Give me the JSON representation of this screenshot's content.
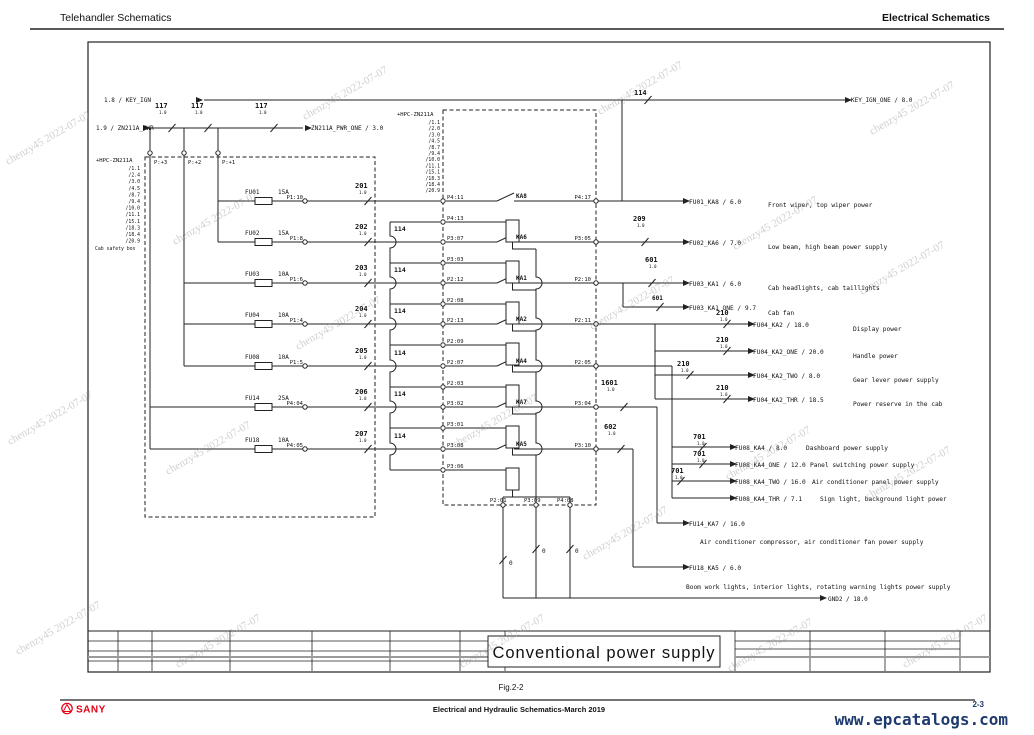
{
  "header": {
    "left": "Telehandler Schematics",
    "right": "Electrical Schematics"
  },
  "watermark": {
    "text": "chenzy45 2022-07-07"
  },
  "title_block": {
    "title": "Conventional  power  supply"
  },
  "footer": {
    "figure": "Fig.2-2",
    "doc": "Electrical and Hydraulic Schematics-March 2019",
    "page": "2-3",
    "site": "www.epcatalogs.com",
    "brand": "SANY"
  },
  "colors": {
    "brand_red": "#e60012",
    "link_navy": "#1e3a6e",
    "line": "#222222"
  },
  "schematic": {
    "spec": "1.0",
    "bus114": "114",
    "top": {
      "key_ign": "1.8 / KEY_IGN",
      "key_ign_one": "KEY_IGN_ONE / 8.0",
      "wire_114": "114",
      "zn_pwr": "1.9 / ZN211A_PWR",
      "zn_pwr_one": "ZN211A_PWR_ONE / 3.0",
      "wire_117": "117"
    },
    "hpc_left": {
      "name": "+HPC-ZN211A",
      "refs": [
        "/1.1",
        "/2.4",
        "/3.0",
        "/4.5",
        "/8.7",
        "/9.4",
        "/10.0",
        "/11.1",
        "/15.1",
        "/18.3",
        "/18.4",
        "/20.9"
      ],
      "caption": "Cab safety box"
    },
    "hpc_mid": {
      "name": "+HPC-ZN211A",
      "refs": [
        "/1.1",
        "/2.0",
        "/3.0",
        "/4.5",
        "/8.7",
        "/9.4",
        "/10.0",
        "/11.1",
        "/15.1",
        "/18.3",
        "/18.4",
        "/20.9"
      ]
    },
    "plus_pins": [
      "P:+3",
      "P:+2",
      "P:+1"
    ],
    "fuses": [
      {
        "name": "FU01",
        "rating": "15A",
        "pin": "P1:10",
        "wire": "201"
      },
      {
        "name": "FU02",
        "rating": "15A",
        "pin": "P1:8",
        "wire": "202"
      },
      {
        "name": "FU03",
        "rating": "10A",
        "pin": "P1:6",
        "wire": "203"
      },
      {
        "name": "FU04",
        "rating": "10A",
        "pin": "P1:4",
        "wire": "204"
      },
      {
        "name": "FU08",
        "rating": "10A",
        "pin": "P1:5",
        "wire": "205"
      },
      {
        "name": "FU14",
        "rating": "25A",
        "pin": "P4:04",
        "wire": "206"
      },
      {
        "name": "FU18",
        "rating": "10A",
        "pin": "P4:05",
        "wire": "207"
      }
    ],
    "relays": [
      {
        "name": "KA8",
        "in": "P4:11",
        "coil": "P4:13",
        "out": "P4:17"
      },
      {
        "name": "KA6",
        "in": "P3:07",
        "coil": "P3:03",
        "out": "P3:05"
      },
      {
        "name": "KA1",
        "in": "P2:12",
        "coil": "P2:08",
        "out": "P2:10"
      },
      {
        "name": "KA2",
        "in": "P2:13",
        "coil": "P2:09",
        "out": "P2:11"
      },
      {
        "name": "KA4",
        "in": "P2:07",
        "coil": "P2:03",
        "out": "P2:05"
      },
      {
        "name": "KA7",
        "in": "P3:02",
        "coil": "P3:01",
        "out": "P3:04"
      },
      {
        "name": "KA5",
        "in": "P3:08",
        "coil": "P3:06",
        "out": "P3:10"
      }
    ],
    "ground_pins": [
      "P2:01",
      "P3:09",
      "P4:08"
    ],
    "ground_wire": "0",
    "gnd": "GND2 / 18.0",
    "outputs": [
      {
        "label": "FU01_KA8 / 6.0",
        "desc": "Front wiper, top wiper power"
      },
      {
        "label": "FU02_KA6 / 7.0",
        "desc": "Low beam, high beam power supply",
        "wire": "209"
      },
      {
        "label": "FU03_KA1 / 6.0",
        "desc": "Cab headlights, cab taillights",
        "wire": "601"
      },
      {
        "label": "FU03_KA1_ONE / 9.7",
        "desc": "Cab fan",
        "wire": "601"
      },
      {
        "label": "FU04_KA2 / 18.0",
        "desc": "Display power",
        "wire": "210"
      },
      {
        "label": "FU04_KA2_ONE / 20.0",
        "desc": "Handle power",
        "wire": "210"
      },
      {
        "label": "FU04_KA2_TWO / 8.0",
        "desc": "Gear lever power supply",
        "wire": "210"
      },
      {
        "label": "FU04_KA2_THR / 18.5",
        "desc": "Power reserve in the cab",
        "wire": "210"
      },
      {
        "label": "FU08_KA4 / 8.0",
        "desc": "Dashboard power supply",
        "wire": "701"
      },
      {
        "label": "FU08_KA4_ONE / 12.0",
        "desc": "Panel switching power supply",
        "wire": "701"
      },
      {
        "label": "FU08_KA4_TWO / 16.0",
        "desc": "Air conditioner panel power supply",
        "wire": "701"
      },
      {
        "label": "FU08_KA4_THR / 7.1",
        "desc": "Sign light, background light power"
      },
      {
        "label": "FU14_KA7 / 16.0",
        "desc": "Air conditioner compressor, air conditioner fan power supply",
        "wire": "1601"
      },
      {
        "label": "FU18_KA5 / 6.0",
        "desc": "Boom work lights, interior lights, rotating warning lights power supply",
        "wire": "602"
      }
    ]
  }
}
